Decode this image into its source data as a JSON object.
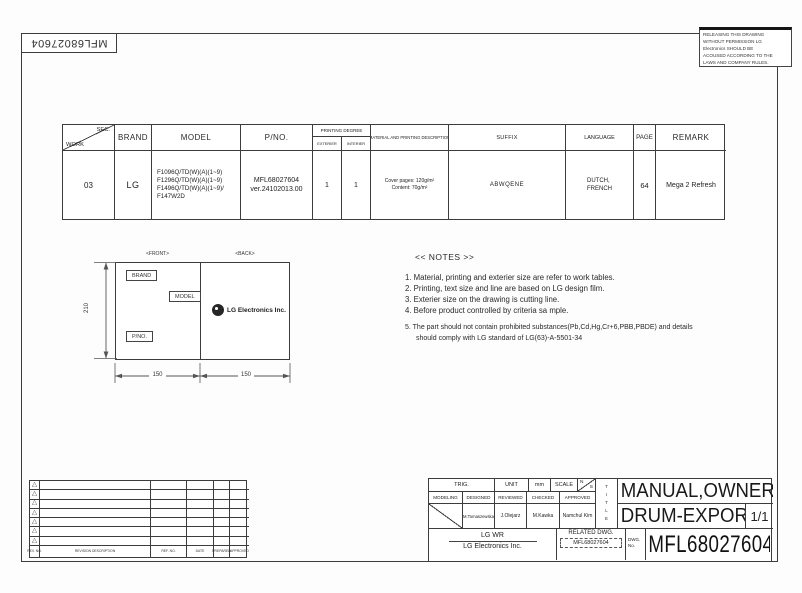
{
  "sheet": {
    "doc_number_rotated": "MFL68027604"
  },
  "notice": {
    "lines": [
      "RELEASING THIS DRAWING",
      "WITHOUT PERMISSION LG",
      "Electronics SHOULD BE",
      "ACOUSED ACCORDING TO THE",
      "LAWS AND COMPANY RULES."
    ]
  },
  "work_table": {
    "header": {
      "sec": "SEC.",
      "work": "WORK",
      "brand": "BRAND",
      "model": "MODEL",
      "pno": "P/NO.",
      "printing_degree": "PRINTING DEGREE",
      "exterier": "EXTERIER",
      "interier": "INTERIER",
      "material": "MATERIAL AND PRINTING DESCRIPTION",
      "suffix": "SUFFIX",
      "language": "LANGUAGE",
      "page": "PAGE",
      "remark": "REMARK"
    },
    "row": {
      "work": "03",
      "brand": "LG",
      "model_lines": [
        "F1096Q/TD(W)(A)(1~9)",
        "F1296Q/TD(W)(A)(1~9)",
        "F1496Q/TD(W)(A)(1~9)/",
        "F147W2D"
      ],
      "pno_line1": "MFL68027604",
      "pno_line2": "ver.24102013.00",
      "exterier": "1",
      "interier": "1",
      "material_line1": "Cover pages: 120g/m²",
      "material_line2": "Content: 70g/m²",
      "suffix": "ABWQENE",
      "language_line1": "DUTCH,",
      "language_line2": "FRENCH",
      "page": "64",
      "remark": "Mega 2  Refresh"
    }
  },
  "diagram": {
    "front_label": "<FRONT>",
    "back_label": "<BACK>",
    "brand_tag": "BRAND",
    "model_tag": "MODEL",
    "pno_tag": "P/NO.",
    "logo_text": "LG Electronics Inc.",
    "dim_height": "210",
    "dim_width_left": "150",
    "dim_width_right": "150"
  },
  "notes": {
    "title": "<< NOTES >>",
    "items": [
      "1. Material, printing and exterier size  are refer to work tables.",
      "2. Printing, text size and line are based on LG design film.",
      "3. Exterier size on the drawing is cutting line.",
      "4. Before product controlled by criteria sa mple.",
      "5. The part should not contain prohibited substances(Pb,Cd,Hg,Cr+6,PBB,PBDE) and details",
      "should comply with LG standard of LG(63)-A-5501-34"
    ]
  },
  "revision_table": {
    "marker": "△",
    "headers": [
      "REV. NO.",
      "REVISION DESCRIPTION",
      "REF. NO.",
      "DATE",
      "PREPARED",
      "APPROVED"
    ]
  },
  "title_block": {
    "trig": "TRIG.",
    "unit_label": "UNIT",
    "unit_value": "mm",
    "scale_label": "SCALE",
    "scale_n": "N",
    "scale_s": "S",
    "roles": [
      "MODELING",
      "DESIGNED",
      "REVIEWED",
      "CHECKED",
      "APPROVED"
    ],
    "names": [
      "M.Tomaszewska",
      "J.Olejarz",
      "M.Kawka",
      "Namchul Kim"
    ],
    "title_vertical": "TITLE",
    "title_line1": "MANUAL,OWNER'S",
    "title_line2": "DRUM-EXPORT",
    "sheet_number": "1/1",
    "company_dept": "LG WR",
    "company_name": "LG Electronics Inc.",
    "related_label": "RELATED DWG.",
    "related_value": "MFL68027604",
    "dwg_label_line1": "DWG.",
    "dwg_label_line2": "No.",
    "dwg_number": "MFL68027604"
  },
  "colors": {
    "line": "#3c3c3c",
    "text": "#222222"
  }
}
